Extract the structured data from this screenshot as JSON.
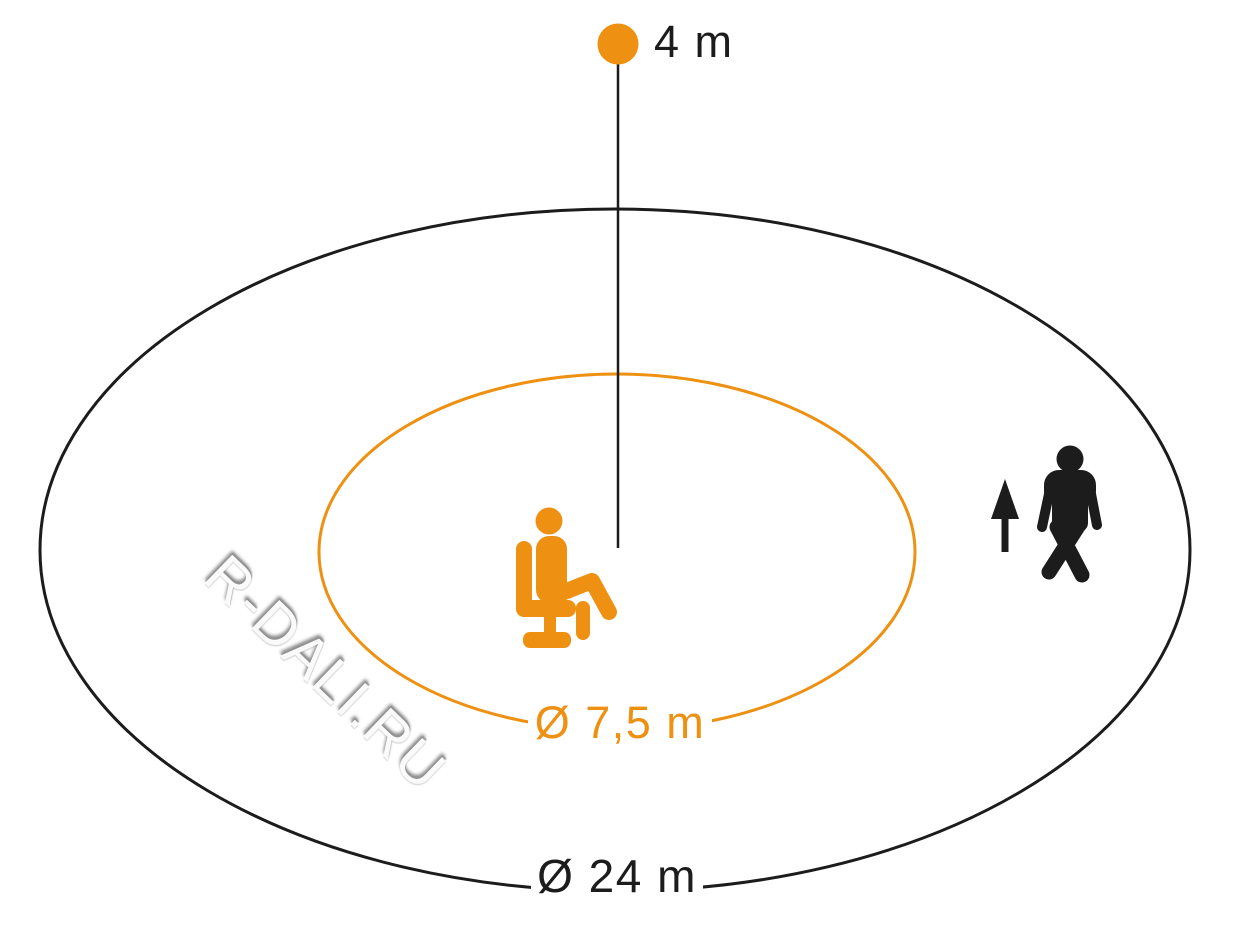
{
  "labels": {
    "mount_height": "4 m",
    "inner_diameter": "Ø 7,5 m",
    "outer_diameter": "Ø 24 m"
  },
  "watermark": "R-DALI.RU",
  "icons": {
    "sensor_dot": "sensor-dot-icon",
    "seated_person": "seated-person-icon",
    "walking_person": "walking-person-icon",
    "up_arrow": "up-arrow-icon"
  },
  "colors": {
    "accent": "#EE9011",
    "ink": "#1C1C1C",
    "background": "#FFFFFF",
    "watermark_face": "#FAFAFA",
    "watermark_shadow": "#8E8E8E"
  }
}
